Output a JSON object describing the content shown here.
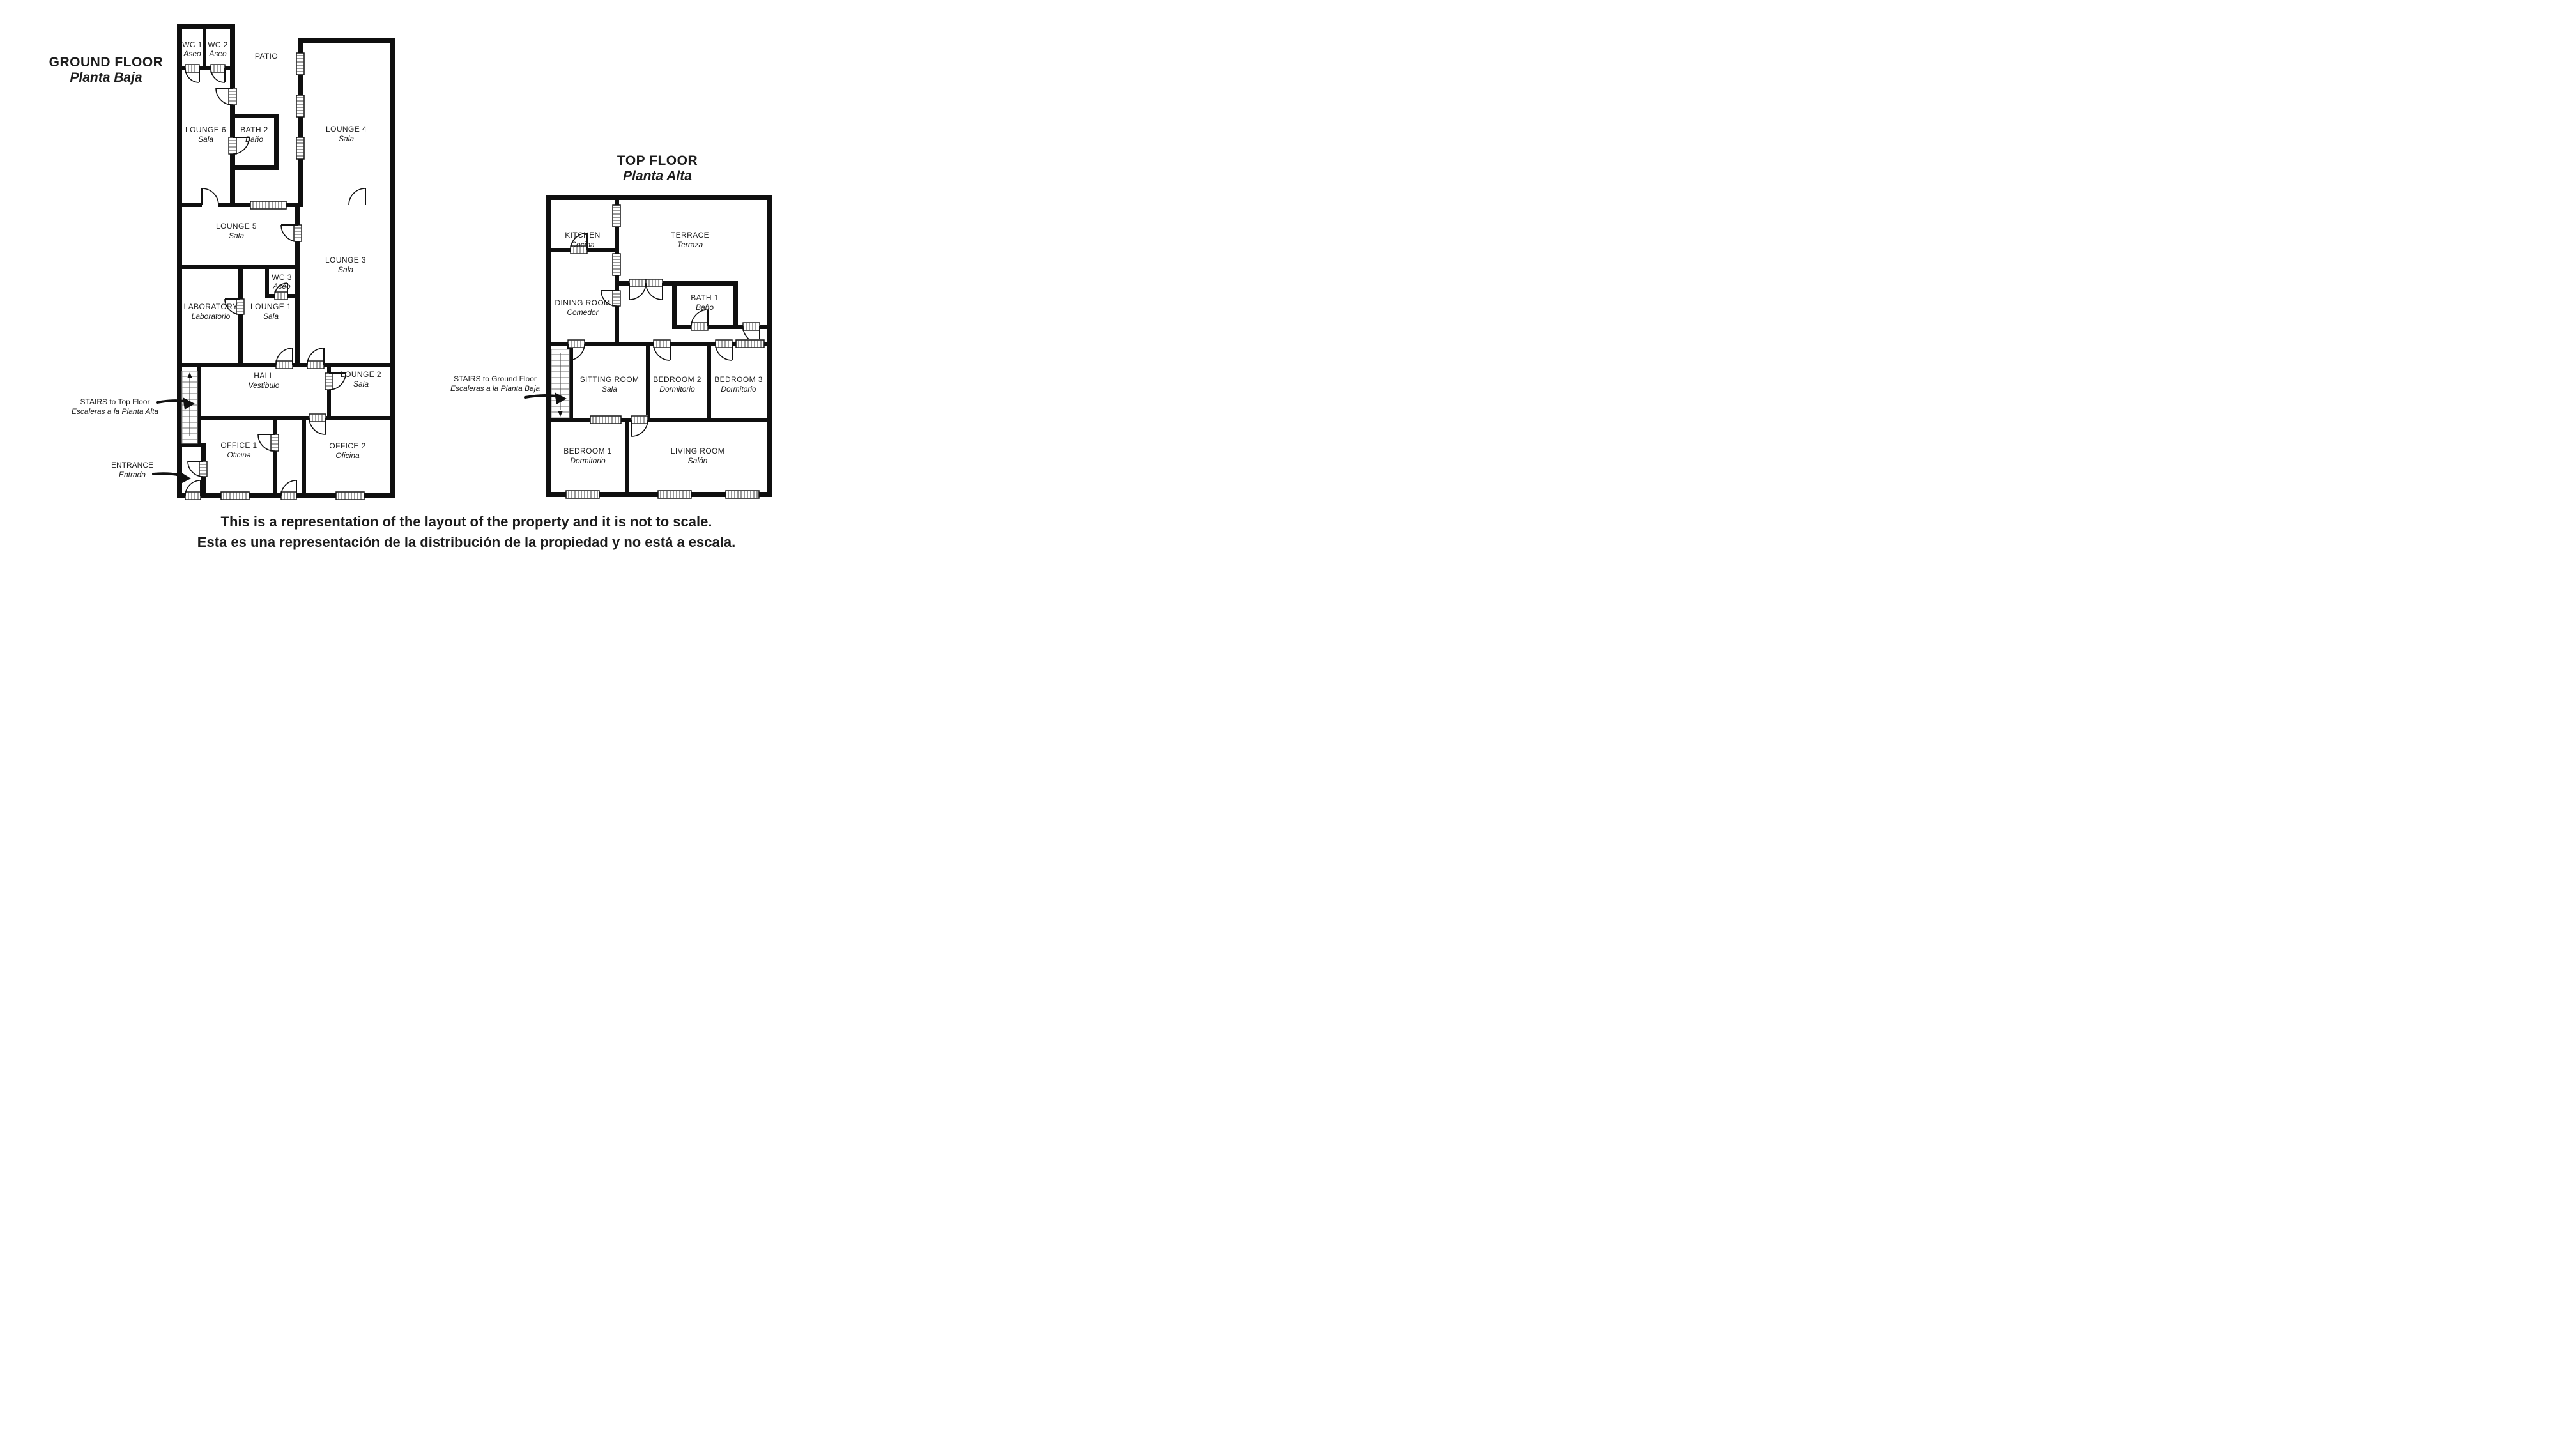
{
  "ground": {
    "title": "GROUND FLOOR",
    "subtitle": "Planta Baja",
    "rooms": {
      "wc1": {
        "en": "WC 1",
        "es": "Aseo"
      },
      "wc2": {
        "en": "WC 2",
        "es": "Aseo"
      },
      "patio": {
        "en": "PATIO"
      },
      "lounge6": {
        "en": "LOUNGE 6",
        "es": "Sala"
      },
      "bath2": {
        "en": "BATH 2",
        "es": "Baño"
      },
      "lounge4": {
        "en": "LOUNGE 4",
        "es": "Sala"
      },
      "lounge5": {
        "en": "LOUNGE 5",
        "es": "Sala"
      },
      "lounge3": {
        "en": "LOUNGE 3",
        "es": "Sala"
      },
      "wc3": {
        "en": "WC 3",
        "es": "Aseo"
      },
      "laboratory": {
        "en": "LABORATORY",
        "es": "Laboratorio"
      },
      "lounge1": {
        "en": "LOUNGE 1",
        "es": "Sala"
      },
      "hall": {
        "en": "HALL",
        "es": "Vestibulo"
      },
      "lounge2": {
        "en": "LOUNGE 2",
        "es": "Sala"
      },
      "office1": {
        "en": "OFFICE 1",
        "es": "Oficina"
      },
      "office2": {
        "en": "OFFICE 2",
        "es": "Oficina"
      }
    },
    "annotations": {
      "stairs": {
        "en": "STAIRS to Top Floor",
        "es": "Escaleras a la Planta Alta"
      },
      "entrance": {
        "en": "ENTRANCE",
        "es": "Entrada"
      }
    }
  },
  "top": {
    "title": "TOP FLOOR",
    "subtitle": "Planta Alta",
    "rooms": {
      "kitchen": {
        "en": "KITCHEN",
        "es": "Cocina"
      },
      "terrace": {
        "en": "TERRACE",
        "es": "Terraza"
      },
      "dining": {
        "en": "DINING ROOM",
        "es": "Comedor"
      },
      "bath1": {
        "en": "BATH 1",
        "es": "Baño"
      },
      "sitting": {
        "en": "SITTING ROOM",
        "es": "Sala"
      },
      "bedroom2": {
        "en": "BEDROOM 2",
        "es": "Dormitorio"
      },
      "bedroom3": {
        "en": "BEDROOM 3",
        "es": "Dormitorio"
      },
      "bedroom1": {
        "en": "BEDROOM 1",
        "es": "Dormitorio"
      },
      "living": {
        "en": "LIVING ROOM",
        "es": "Salón"
      }
    },
    "annotations": {
      "stairs": {
        "en": "STAIRS to Ground Floor",
        "es": "Escaleras a la Planta Baja"
      }
    }
  },
  "disclaimer": {
    "en": "This is a representation of the layout of the property and it is not to scale.",
    "es": "Esta es una representación de la distribución de la propiedad y no está a escala."
  },
  "colors": {
    "wall": "#0f0f0f",
    "disclaimer_en": "#000000",
    "disclaimer_es": "#fd0000"
  }
}
